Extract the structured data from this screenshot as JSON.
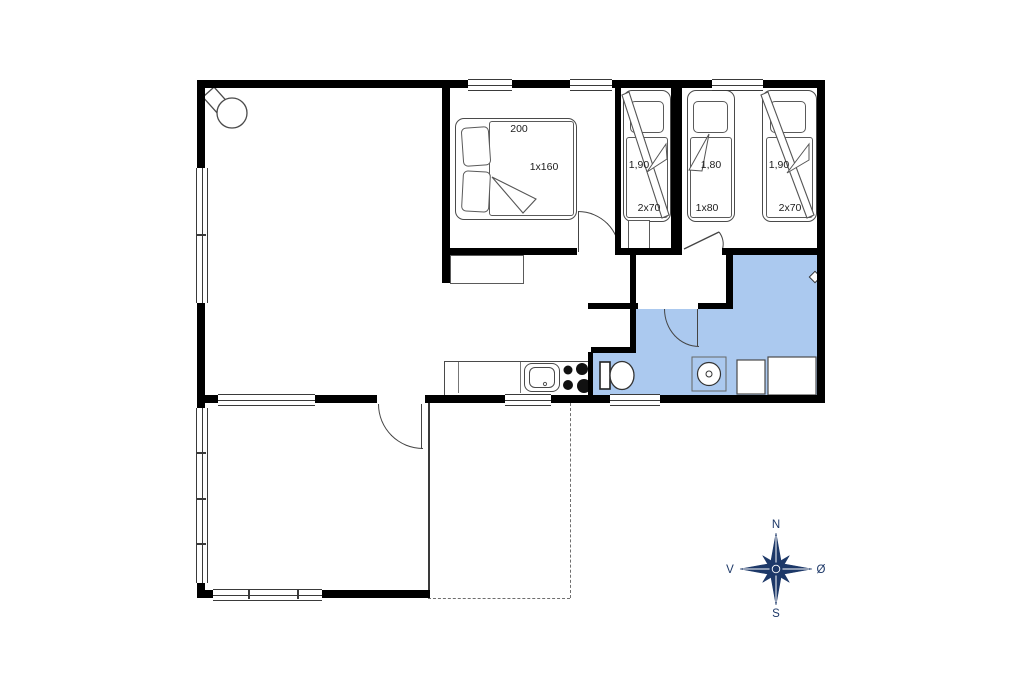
{
  "plan": {
    "labels": {
      "master_length": "200",
      "master_bed": "1x160",
      "bunk1_length": "1,90",
      "bunk1_bed": "2x70",
      "single_length": "1,80",
      "single_bed": "1x80",
      "bunk2_length": "1,90",
      "bunk2_bed": "2x70"
    },
    "compass": {
      "north": "N",
      "south": "S",
      "west": "V",
      "east": "Ø"
    },
    "colors": {
      "wall": "#000000",
      "bathroom_fill": "#abc9ef",
      "compass_navy": "#1d3868",
      "outline_gray": "#4a4a4a",
      "background": "#ffffff"
    }
  }
}
